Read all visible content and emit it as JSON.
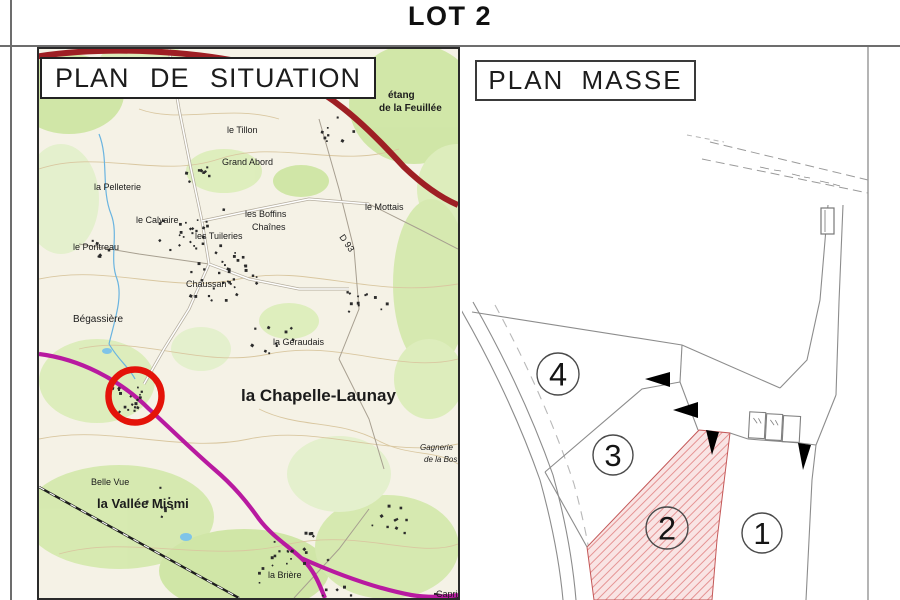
{
  "title": "LOT 2",
  "situation": {
    "header": "PLAN DE SITUATION",
    "marker_color": "#e41309",
    "labels": [
      {
        "t": "le Landas",
        "x": 120,
        "y": 20,
        "s": 9
      },
      {
        "t": "étang",
        "x": 349,
        "y": 49,
        "s": 10,
        "b": 1
      },
      {
        "t": "de la Feuillée",
        "x": 340,
        "y": 62,
        "s": 10,
        "b": 1
      },
      {
        "t": "le Tillon",
        "x": 188,
        "y": 84,
        "s": 9
      },
      {
        "t": "Grand Abord",
        "x": 183,
        "y": 116,
        "s": 9
      },
      {
        "t": "la Pelleterie",
        "x": 55,
        "y": 141,
        "s": 9
      },
      {
        "t": "les Boffins",
        "x": 206,
        "y": 168,
        "s": 9
      },
      {
        "t": "Chaînes",
        "x": 213,
        "y": 181,
        "s": 9
      },
      {
        "t": "le Mottais",
        "x": 326,
        "y": 161,
        "s": 9
      },
      {
        "t": "le Calvaire",
        "x": 97,
        "y": 174,
        "s": 9
      },
      {
        "t": "les Tuileries",
        "x": 156,
        "y": 190,
        "s": 9
      },
      {
        "t": "le Pontreau",
        "x": 34,
        "y": 201,
        "s": 9
      },
      {
        "t": "D 93",
        "x": 300,
        "y": 188,
        "s": 9,
        "r": 55
      },
      {
        "t": "Chaussan",
        "x": 147,
        "y": 238,
        "s": 9
      },
      {
        "t": "Bégassière",
        "x": 34,
        "y": 273,
        "s": 10
      },
      {
        "t": "la Géraudais",
        "x": 234,
        "y": 296,
        "s": 9
      },
      {
        "t": "la Chapelle-Launay",
        "x": 202,
        "y": 352,
        "s": 17,
        "b": 1
      },
      {
        "t": "Gagnerie",
        "x": 381,
        "y": 401,
        "s": 8,
        "i": 1
      },
      {
        "t": "de la Bos",
        "x": 385,
        "y": 413,
        "s": 8,
        "i": 1
      },
      {
        "t": "Belle Vue",
        "x": 52,
        "y": 436,
        "s": 9
      },
      {
        "t": "la Vallée Mismi",
        "x": 58,
        "y": 459,
        "s": 13,
        "b": 1
      },
      {
        "t": "la Brière",
        "x": 229,
        "y": 529,
        "s": 9
      },
      {
        "t": "Capric",
        "x": 397,
        "y": 548,
        "s": 9
      }
    ]
  },
  "masse": {
    "header": "PLAN MASSE",
    "hatch_fill": "#f9e4e4",
    "hatch_line": "#e59393",
    "lots": [
      {
        "label": "4",
        "cx": 96,
        "cy": 327,
        "r": 21,
        "hatched": false
      },
      {
        "label": "3",
        "cx": 151,
        "cy": 408,
        "r": 20,
        "hatched": false
      },
      {
        "label": "2",
        "cx": 205,
        "cy": 481,
        "r": 21,
        "hatched": true
      },
      {
        "label": "1",
        "cx": 300,
        "cy": 486,
        "r": 20,
        "hatched": false
      }
    ]
  }
}
